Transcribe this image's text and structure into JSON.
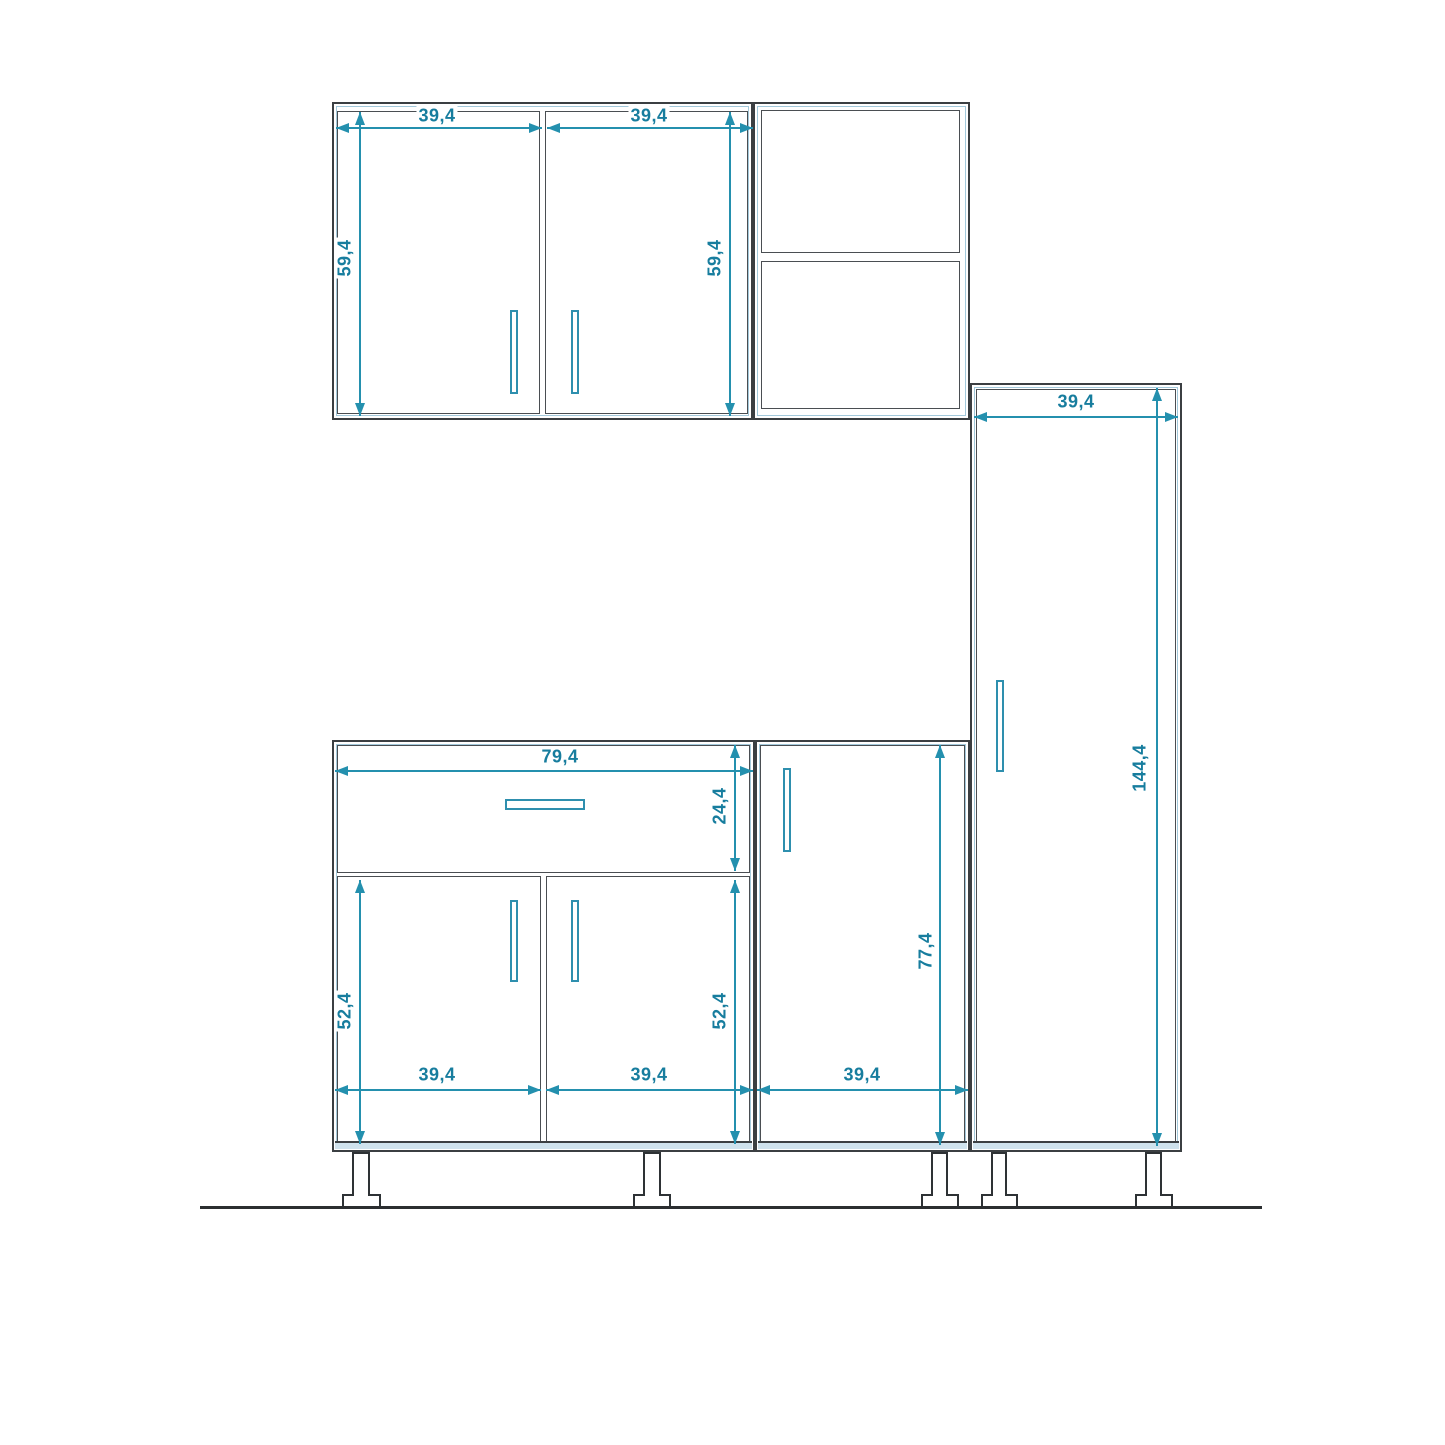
{
  "drawing": {
    "title": "kitchen-cabinet-set-front-elevation"
  },
  "colors": {
    "accent": "#177d9e",
    "dim": "#2490ae",
    "outline": "#3b3f42",
    "carcass": "#a3c9db",
    "band": "#cfe2ed"
  },
  "dims": {
    "wall_left_w": "39,4",
    "wall_right_w": "39,4",
    "wall_left_h": "59,4",
    "wall_right_h": "59,4",
    "tall_w": "39,4",
    "tall_h": "144,4",
    "base_w": "79,4",
    "drawer_h": "24,4",
    "base_door_left_h": "52,4",
    "base_door_right_h": "52,4",
    "base_door_left_w": "39,4",
    "base_door_right_w": "39,4",
    "single_door_h": "77,4",
    "single_w": "39,4"
  }
}
